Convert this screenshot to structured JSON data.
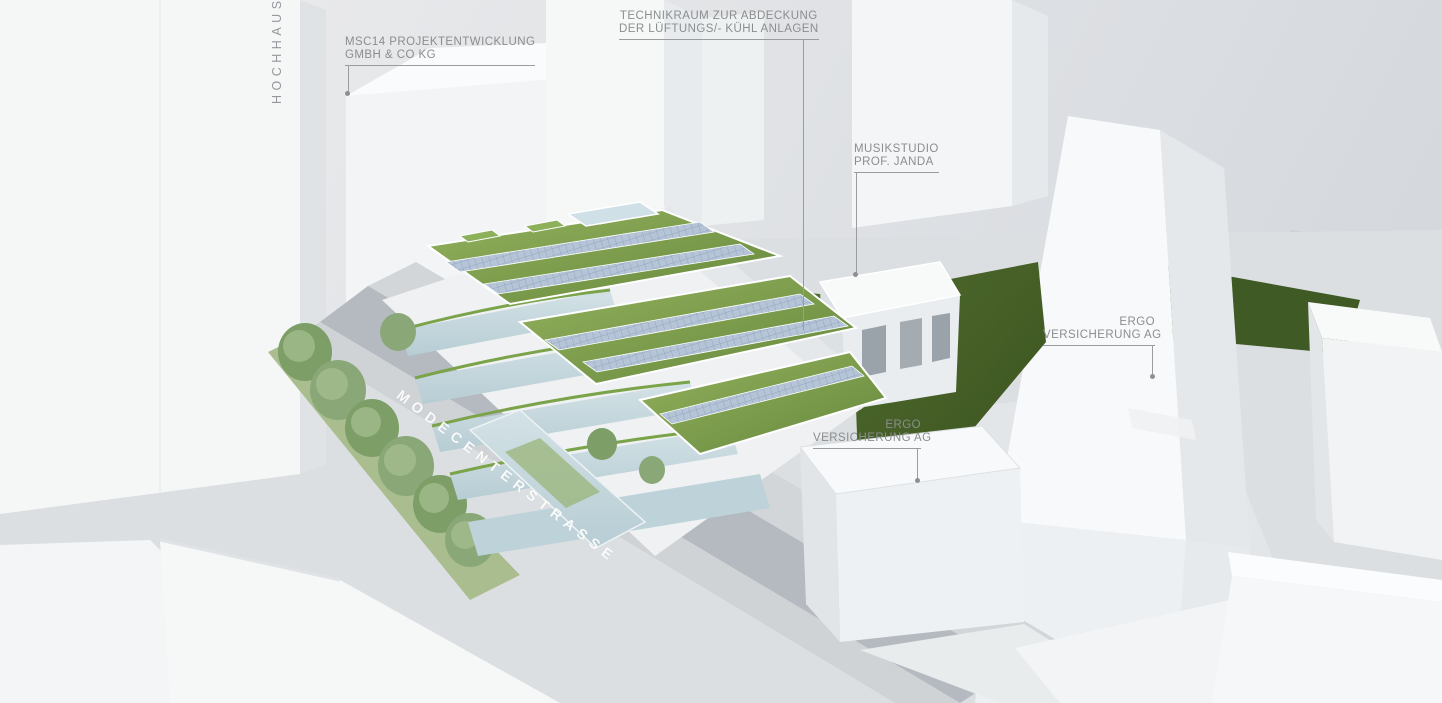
{
  "labels": {
    "hochhaus": {
      "text": "HOCHHAUS"
    },
    "msc14": {
      "line1": "MSC14 PROJEKTENTWICKLUNG",
      "line2": "GMBH & CO KG"
    },
    "technikraum": {
      "line1": "TECHNIKRAUM ZUR ABDECKUNG",
      "line2": "DER LÜFTUNGS/- KÜHL ANLAGEN"
    },
    "musikstudio": {
      "line1": "MUSIKSTUDIO",
      "line2": "PROF. JANDA"
    },
    "ergo_right": {
      "line1": "ERGO",
      "line2": "VERSICHERUNG AG"
    },
    "ergo_center": {
      "line1": "ERGO",
      "line2": "VERSICHERUNG AG"
    },
    "street": {
      "text": "MODECENTERSTRASSE"
    }
  },
  "colors": {
    "annotation_text": "#8b8d8e",
    "leader_line": "#9a9ca0",
    "street_text": "#ffffff",
    "building_white": "#f4f6f7",
    "green_roof": "#7ba04c",
    "solar_panel": "#b5c4d6",
    "lawn_dark": "#46602a",
    "street_asphalt": "#b4bac0"
  }
}
